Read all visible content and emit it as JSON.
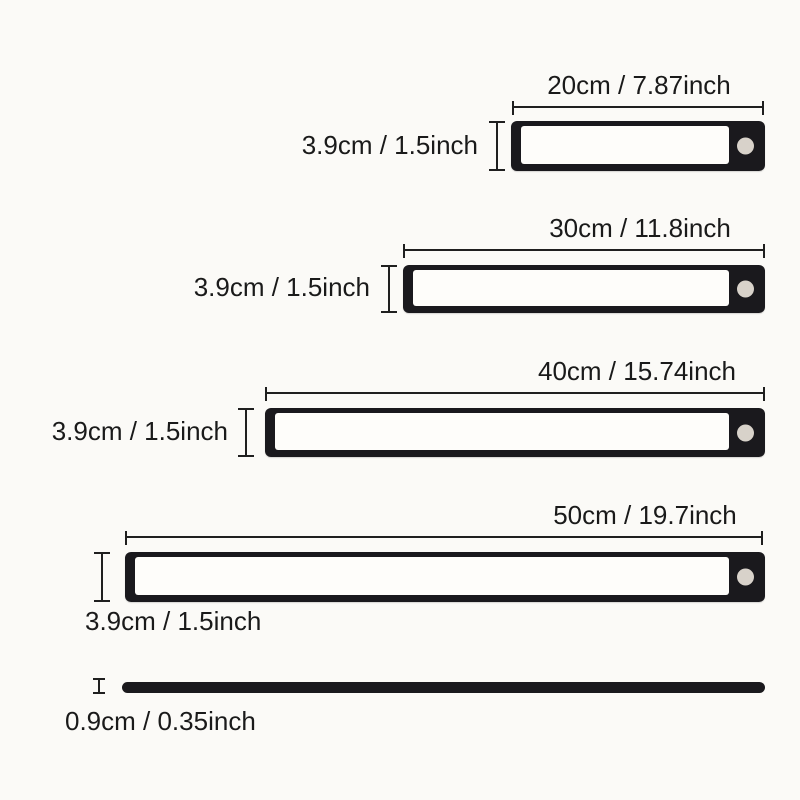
{
  "figure": {
    "description": "Product size diagram of magnetic under-cabinet LED light bars",
    "background_color": "#fbfaf7",
    "bar_color": "#1a191d",
    "panel_color": "#fefdfa",
    "sensor_color": "#d8d2ca",
    "line_color": "#1f1f1f",
    "text_color": "#1a1a1a",
    "items": [
      {
        "name": "light-bar-20cm",
        "width_label": "20cm / 7.87inch",
        "height_label": "3.9cm / 1.5inch"
      },
      {
        "name": "light-bar-30cm",
        "width_label": "30cm / 11.8inch",
        "height_label": "3.9cm / 1.5inch"
      },
      {
        "name": "light-bar-40cm",
        "width_label": "40cm / 15.74inch",
        "height_label": "3.9cm / 1.5inch"
      },
      {
        "name": "light-bar-50cm",
        "width_label": "50cm / 19.7inch",
        "height_label": "3.9cm / 1.5inch"
      },
      {
        "name": "side-profile",
        "height_label": "0.9cm / 0.35inch"
      }
    ]
  }
}
